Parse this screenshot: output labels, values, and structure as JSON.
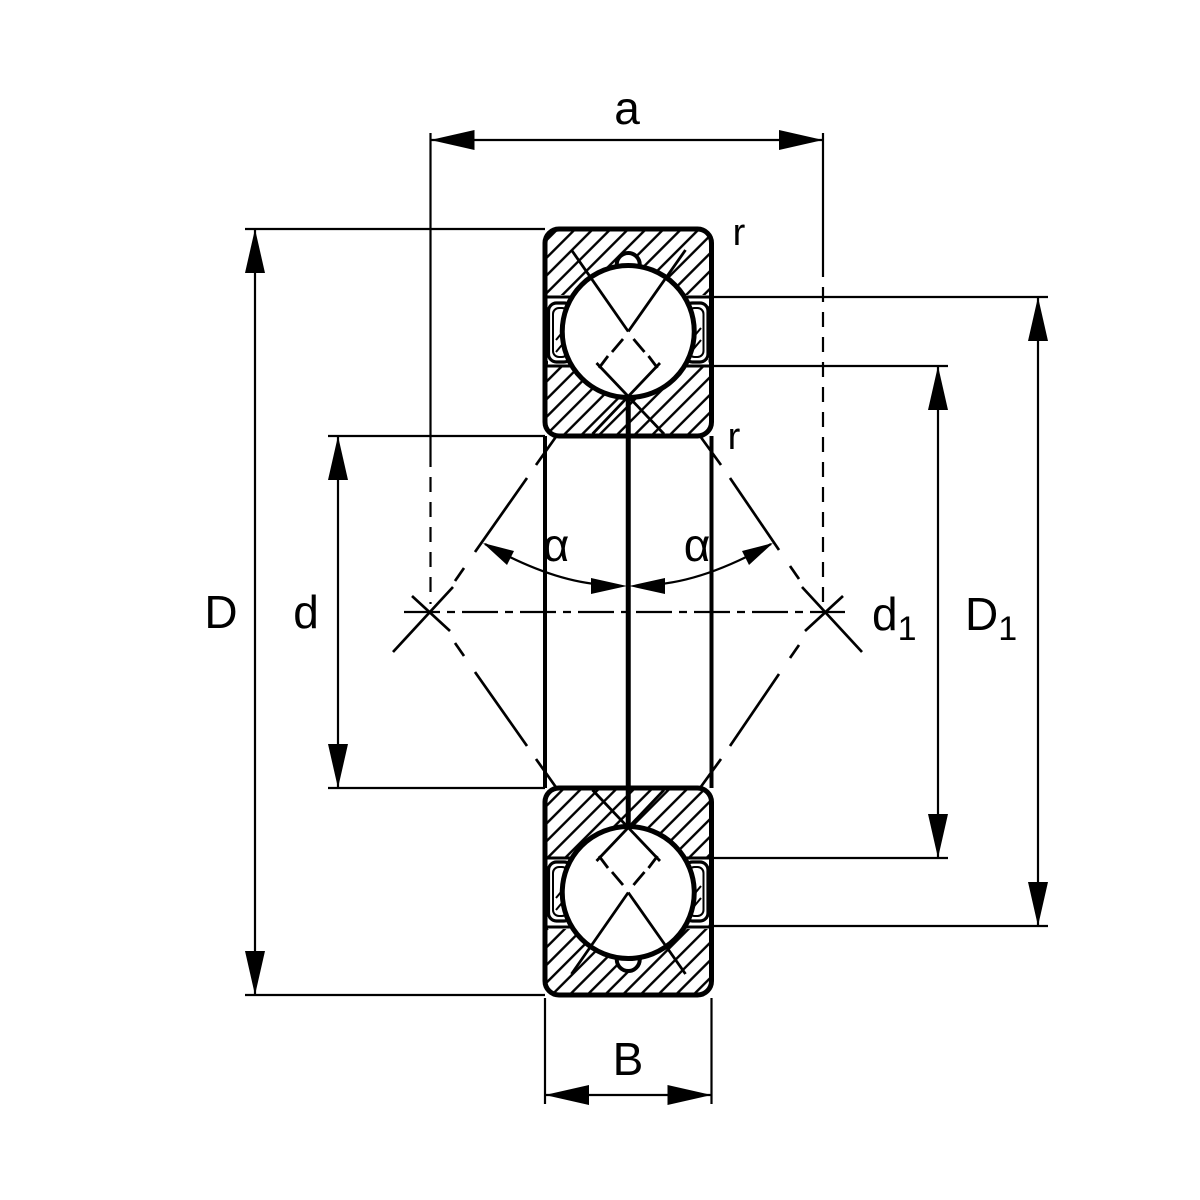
{
  "diagram": {
    "labels": {
      "a": "a",
      "r_top": "r",
      "r_bottom": "r",
      "alpha_left": "α",
      "alpha_right": "α",
      "D": "D",
      "d": "d",
      "d1_base": "d",
      "d1_sub": "1",
      "D1_base": "D",
      "D1_sub": "1",
      "B": "B"
    },
    "colors": {
      "ink": "#000000",
      "paper": "#ffffff"
    }
  }
}
